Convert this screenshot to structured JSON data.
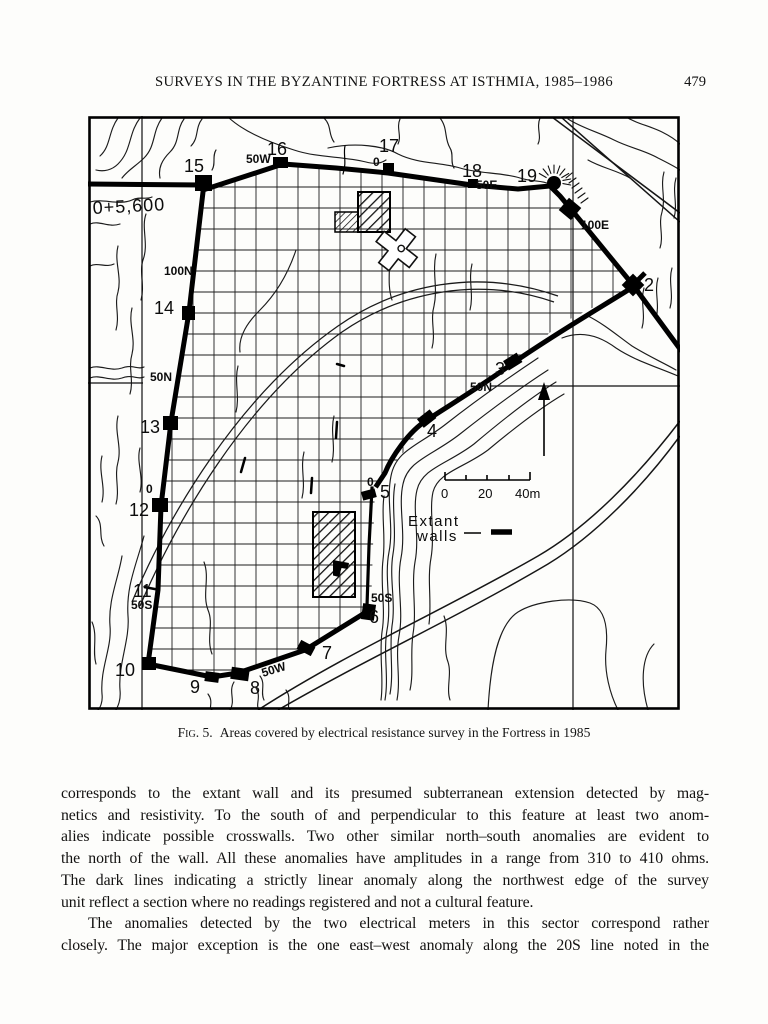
{
  "page": {
    "running_head": "SURVEYS IN THE BYZANTINE FORTRESS AT ISTHMIA, 1985–1986",
    "page_number": "479"
  },
  "figure": {
    "caption_label": "Fig. 5.",
    "caption_text": "Areas covered by electrical resistance survey in the Fortress in 1985",
    "map": {
      "legend": {
        "line1": "Extant",
        "line2": "walls"
      },
      "scale_ticks": [
        "0",
        "20",
        "40m"
      ],
      "datum_label": "0+5,600",
      "labels": [
        {
          "name": "tower-label-15",
          "text": "15",
          "x": 96,
          "y": 56,
          "size": 18
        },
        {
          "name": "tower-label-16",
          "text": "16",
          "x": 179,
          "y": 39,
          "size": 18
        },
        {
          "name": "tower-label-17",
          "text": "17",
          "x": 291,
          "y": 36,
          "size": 18
        },
        {
          "name": "tower-label-18",
          "text": "18",
          "x": 374,
          "y": 61,
          "size": 18
        },
        {
          "name": "tower-label-19",
          "text": "19",
          "x": 429,
          "y": 66,
          "size": 18
        },
        {
          "name": "tower-label-2",
          "text": "2",
          "x": 556,
          "y": 175,
          "size": 18
        },
        {
          "name": "tower-label-3",
          "text": "3",
          "x": 407,
          "y": 259,
          "size": 18
        },
        {
          "name": "tower-label-4",
          "text": "4",
          "x": 339,
          "y": 321,
          "size": 18
        },
        {
          "name": "tower-label-5",
          "text": "5",
          "x": 292,
          "y": 382,
          "size": 18
        },
        {
          "name": "tower-label-6",
          "text": "6",
          "x": 281,
          "y": 507,
          "size": 18
        },
        {
          "name": "tower-label-7",
          "text": "7",
          "x": 234,
          "y": 543,
          "size": 18
        },
        {
          "name": "tower-label-8",
          "text": "8",
          "x": 162,
          "y": 578,
          "size": 18
        },
        {
          "name": "tower-label-9",
          "text": "9",
          "x": 102,
          "y": 577,
          "size": 18
        },
        {
          "name": "tower-label-10",
          "text": "10",
          "x": 27,
          "y": 560,
          "size": 18
        },
        {
          "name": "tower-label-11",
          "text": "11",
          "x": 45,
          "y": 481,
          "size": 18
        },
        {
          "name": "tower-label-12",
          "text": "12",
          "x": 41,
          "y": 400,
          "size": 18
        },
        {
          "name": "tower-label-13",
          "text": "13",
          "x": 52,
          "y": 317,
          "size": 18
        },
        {
          "name": "tower-label-14",
          "text": "14",
          "x": 66,
          "y": 198,
          "size": 18
        },
        {
          "name": "grid-label-50w-north",
          "text": "50W",
          "x": 158,
          "y": 47,
          "size": 12,
          "bold": true
        },
        {
          "name": "grid-label-0-north",
          "text": "0",
          "x": 285,
          "y": 50,
          "size": 12,
          "bold": true
        },
        {
          "name": "grid-label-50e",
          "text": "50E",
          "x": 388,
          "y": 73,
          "size": 12,
          "bold": true
        },
        {
          "name": "grid-label-100e",
          "text": "100E",
          "x": 493,
          "y": 113,
          "size": 12,
          "bold": true
        },
        {
          "name": "grid-label-100n",
          "text": "100N",
          "x": 76,
          "y": 159,
          "size": 12,
          "bold": true
        },
        {
          "name": "grid-label-50n-west",
          "text": "50N",
          "x": 62,
          "y": 265,
          "size": 12,
          "bold": true
        },
        {
          "name": "grid-label-0-west",
          "text": "0",
          "x": 58,
          "y": 377,
          "size": 12,
          "bold": true
        },
        {
          "name": "grid-label-50s-west",
          "text": "50S",
          "x": 43,
          "y": 493,
          "size": 12,
          "bold": true
        },
        {
          "name": "grid-label-50n-east",
          "text": "50N",
          "x": 382,
          "y": 275,
          "size": 12,
          "bold": true
        },
        {
          "name": "grid-label-0-center",
          "text": "0",
          "x": 279,
          "y": 370,
          "size": 12,
          "bold": true
        },
        {
          "name": "grid-label-50s-east",
          "text": "50S",
          "x": 283,
          "y": 486,
          "size": 12,
          "bold": true
        },
        {
          "name": "grid-label-50w-south",
          "text": "50W",
          "x": 175,
          "y": 561,
          "size": 12,
          "bold": true,
          "rotate": -17
        },
        {
          "name": "datum-label",
          "text": "0+5,600",
          "x": 5,
          "y": 98,
          "size": 18,
          "rotate": -3,
          "ls": 1
        },
        {
          "name": "scale-label-0",
          "text": "0",
          "x": 353,
          "y": 382,
          "size": 13
        },
        {
          "name": "scale-label-20",
          "text": "20",
          "x": 390,
          "y": 382,
          "size": 13
        },
        {
          "name": "scale-label-40m",
          "text": "40m",
          "x": 427,
          "y": 382,
          "size": 13
        },
        {
          "name": "legend-label-extant",
          "text": "Extant",
          "x": 320,
          "y": 410,
          "size": 15,
          "ls": 1.5
        },
        {
          "name": "legend-label-walls",
          "text": "walls",
          "x": 329,
          "y": 425,
          "size": 15,
          "ls": 1.5
        }
      ]
    }
  },
  "body": {
    "paragraphs": [
      {
        "lines": [
          {
            "text": "corresponds to the extant wall and its presumed subterranean extension detected by mag-"
          },
          {
            "text": "netics and resistivity. To the south of and perpendicular to this feature at least two anom-"
          },
          {
            "text": "alies indicate possible crosswalls. Two other similar north–south anomalies are evident to"
          },
          {
            "text": "the north of the wall. All these anomalies have amplitudes in a range from 310 to 410 ohms."
          },
          {
            "text": "The dark lines indicating a strictly linear anomaly along the northwest edge of the survey"
          },
          {
            "text": "unit reflect a section where no readings registered and not a cultural feature.",
            "justify": false
          }
        ]
      },
      {
        "lines": [
          {
            "text": "The anomalies detected by the two electrical meters in this sector correspond rather",
            "indent": true
          },
          {
            "text": "closely. The major exception is the one east–west anomaly along the 20S line noted in the"
          }
        ]
      }
    ]
  }
}
